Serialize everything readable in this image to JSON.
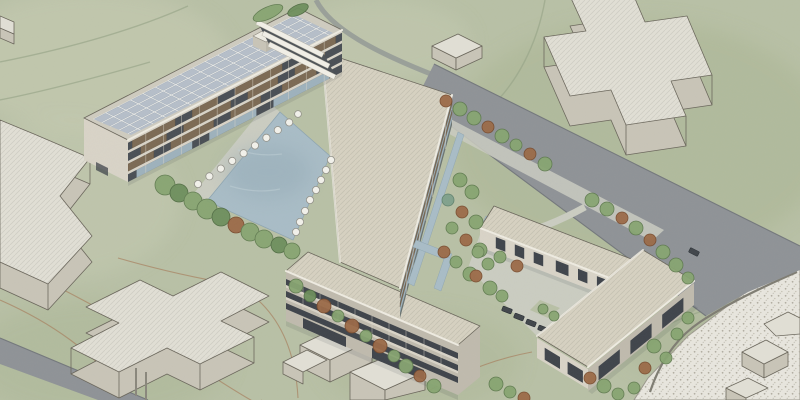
{
  "meta": {
    "kind": "architectural-rendering",
    "view": "aerial axonometric",
    "style": "watercolor sketch visualization",
    "canvas_width": 800,
    "canvas_height": 400
  },
  "scene": {
    "setting": "Watercolor-style aerial rendering of a campus masterplan: a Z-shaped 3-4 storey building complex with a rooftop solar array wraps a rectangular reflecting pond lined with white parasols; a single-storey courtyard building with parking sits to the south-east; white massing blocks (two cross-shaped, several rectangular) stand as context buildings in the surrounding green fields; a road runs diagonally between the site and the fields and a speckled gravel area fills the lower-right corner.",
    "site": {
      "main_complex": {
        "wing_north": {
          "label": "long slab with photovoltaic roof",
          "storeys": 4,
          "features": [
            "solar-panel roof grid",
            "open terraces with timber pergola slats",
            "white rooftop plant box",
            "stepped white link stair at east end"
          ]
        },
        "wing_middle": {
          "label": "wide slab with flat beige roof",
          "features": [
            "east glass facade with timber brise-soleil bands",
            "water channel along east side"
          ]
        },
        "wing_south": {
          "label": "three-storey slab",
          "storeys": 3,
          "features": [
            "dark ribbon windows",
            "flat beige roof",
            "glazed ground floor"
          ]
        },
        "pond": {
          "label": "rectangular reflecting pond",
          "parasol_count": 18,
          "edge_rows": [
            "north-west terrace row",
            "east lawn row"
          ],
          "tree_row": "green trees along south-west bank"
        },
        "courtyard_building": {
          "label": "single-storey L-shaped building",
          "features": [
            "inner paved courtyard",
            "parked cars",
            "glass facades with recessed openings",
            "white parapet roof"
          ]
        }
      },
      "context_blocks": {
        "count": 11,
        "items": [
          "cross-shaped massing north-east",
          "cross-shaped massing south-west",
          "angular massing at west edge",
          "small box north-west corner",
          "small box beside road",
          "three boxes south of complex",
          "three boxes in gravel area"
        ]
      },
      "landscape": {
        "tree_count_approx": 70,
        "tree_colors": [
          "green",
          "dark green",
          "rust-brown",
          "teal"
        ],
        "hedges": 2,
        "ground": "mottled green watercolor fields",
        "contour_paths": "thin red-brown and grey field lines"
      },
      "infrastructure": {
        "roads": [
          "diagonal road north-east of site",
          "road in south-west corner",
          "narrow lane from top edge"
        ],
        "footpaths": [
          "light footpath along the road",
          "courtyard connector path",
          "dark path through gravel area"
        ],
        "parking": {
          "cars": 6
        },
        "gravel_area": "speckled gravel / beach zone in lower-right corner",
        "water_channels": 3
      }
    }
  },
  "palette": {
    "field": "#b9c1a6",
    "field_light": "#ccd0ba",
    "field_dark": "#a2b18c",
    "road": "#8f9397",
    "road_edge": "#74787c",
    "path_light": "#cbcdc2",
    "gravel": "#e9e7df",
    "gravel_dot": "#b3afa3",
    "water": "#a9bdc7",
    "water_deep": "#94aab6",
    "water_edge": "#8fa6b2",
    "roof_beige": "#d7d2c2",
    "roof_fascia": "#efece2",
    "facade_light": "#d9d4c8",
    "facade_shade": "#c0bbae",
    "window_dark": "#3f444b",
    "glass_blue": "#9eb2bd",
    "pergola_brown": "#7c6a54",
    "solar_panel": "#b6bfca",
    "solar_line": "#e9eae8",
    "massing_top": "#e2e0d6",
    "massing_side": "#c9c5b8",
    "outline": "#6b675c",
    "tree_green": "#87a571",
    "tree_green_dark": "#6d8f5c",
    "tree_rust": "#9b6a47",
    "tree_teal": "#7fa18c",
    "parasol": "#f3f2ec",
    "car": "#41464b",
    "contour": "#a8805f"
  }
}
